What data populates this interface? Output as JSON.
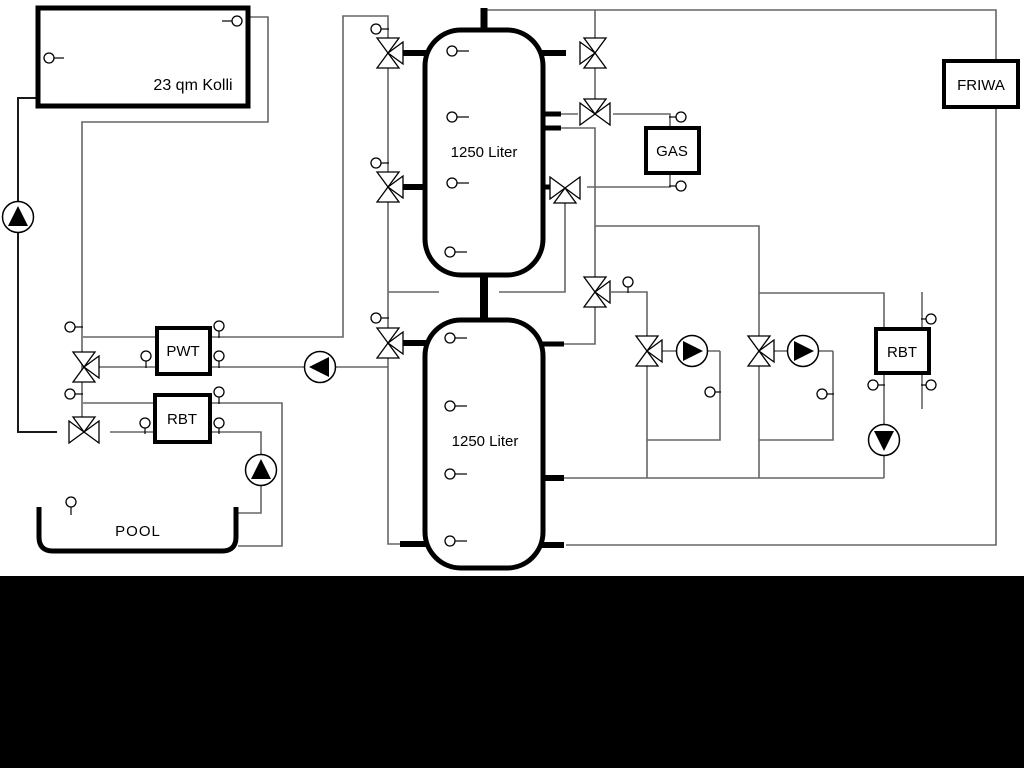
{
  "colors": {
    "background": "#ffffff",
    "band": "#000000",
    "pipe": "#666666",
    "pipe_dark": "#1a1a1a",
    "symbol": "#000000",
    "fill": "#ffffff"
  },
  "labels": {
    "kolli": "23 qm Kolli",
    "tank1": "1250 Liter",
    "tank2": "1250 Liter",
    "pwt": "PWT",
    "rbt_left": "RBT",
    "rbt_right": "RBT",
    "gas": "GAS",
    "friwa": "FRIWA",
    "pool": "POOL"
  },
  "pipes": [
    {
      "name": "pipe-collector-flow",
      "dark": true,
      "pts": [
        [
          38,
          98
        ],
        [
          18,
          98
        ],
        [
          18,
          432
        ],
        [
          57,
          432
        ]
      ]
    },
    {
      "name": "pipe-collector-return",
      "pts": [
        [
          247,
          17
        ],
        [
          268,
          17
        ],
        [
          268,
          122
        ],
        [
          82,
          122
        ],
        [
          82,
          429
        ]
      ]
    },
    {
      "name": "pipe-loading-line",
      "pts": [
        [
          83,
          337
        ],
        [
          343,
          337
        ],
        [
          343,
          16
        ],
        [
          388,
          16
        ],
        [
          388,
          544
        ],
        [
          404,
          544
        ]
      ]
    },
    {
      "name": "pipe-pwt-lower",
      "pts": [
        [
          98,
          367
        ],
        [
          388,
          367
        ]
      ]
    },
    {
      "name": "pipe-rbt-upper-pool",
      "pts": [
        [
          83,
          403
        ],
        [
          282,
          403
        ],
        [
          282,
          546
        ],
        [
          238,
          546
        ]
      ]
    },
    {
      "name": "pipe-rbt-lower-pool",
      "pts": [
        [
          110,
          432
        ],
        [
          261,
          432
        ],
        [
          261,
          513
        ],
        [
          238,
          513
        ]
      ]
    },
    {
      "name": "pipe-top-friwa-loop",
      "pts": [
        [
          484,
          10
        ],
        [
          996,
          10
        ],
        [
          996,
          545
        ],
        [
          566,
          545
        ]
      ]
    },
    {
      "name": "pipe-valve-chain-top",
      "pts": [
        [
          595,
          10
        ],
        [
          595,
          100
        ]
      ]
    },
    {
      "name": "pipe-valve114-left",
      "pts": [
        [
          561,
          114
        ],
        [
          578,
          114
        ]
      ]
    },
    {
      "name": "pipe-valve114-to-gas",
      "pts": [
        [
          613,
          114
        ],
        [
          670,
          114
        ],
        [
          670,
          130
        ]
      ]
    },
    {
      "name": "pipe-tank1-r128-down",
      "pts": [
        [
          561,
          128
        ],
        [
          595,
          128
        ],
        [
          595,
          278
        ]
      ]
    },
    {
      "name": "pipe-gas-return",
      "pts": [
        [
          670,
          171
        ],
        [
          670,
          187
        ],
        [
          587,
          187
        ]
      ]
    },
    {
      "name": "pipe-valve188-down",
      "pts": [
        [
          565,
          202
        ],
        [
          565,
          292
        ],
        [
          499,
          292
        ]
      ]
    },
    {
      "name": "pipe-292-left-segment",
      "pts": [
        [
          388,
          292
        ],
        [
          439,
          292
        ]
      ]
    },
    {
      "name": "pipe-226-branch2",
      "pts": [
        [
          595,
          226
        ],
        [
          759,
          226
        ],
        [
          759,
          338
        ]
      ]
    },
    {
      "name": "pipe-valve292-right",
      "pts": [
        [
          611,
          292
        ],
        [
          647,
          292
        ],
        [
          647,
          338
        ]
      ]
    },
    {
      "name": "pipe-valve292-bottom",
      "pts": [
        [
          595,
          307
        ],
        [
          595,
          344
        ],
        [
          564,
          344
        ]
      ]
    },
    {
      "name": "pipe-branch1-pump",
      "pts": [
        [
          660,
          351
        ],
        [
          720,
          351
        ]
      ]
    },
    {
      "name": "pipe-branch1-loop",
      "pts": [
        [
          720,
          351
        ],
        [
          720,
          440
        ],
        [
          647,
          440
        ]
      ]
    },
    {
      "name": "pipe-branch1-drop",
      "pts": [
        [
          647,
          366
        ],
        [
          647,
          478
        ]
      ]
    },
    {
      "name": "pipe-branch2-pump",
      "pts": [
        [
          771,
          351
        ],
        [
          833,
          351
        ]
      ]
    },
    {
      "name": "pipe-branch2-loop",
      "pts": [
        [
          833,
          351
        ],
        [
          833,
          440
        ],
        [
          759,
          440
        ]
      ]
    },
    {
      "name": "pipe-branch2-drop",
      "pts": [
        [
          759,
          366
        ],
        [
          759,
          478
        ]
      ]
    },
    {
      "name": "pipe-branch2-to-rbt",
      "pts": [
        [
          759,
          293
        ],
        [
          884,
          293
        ],
        [
          884,
          330
        ]
      ]
    },
    {
      "name": "pipe-return-478",
      "pts": [
        [
          564,
          478
        ],
        [
          884,
          478
        ]
      ]
    },
    {
      "name": "pipe-rbt-right-pump",
      "pts": [
        [
          884,
          372
        ],
        [
          884,
          478
        ]
      ]
    },
    {
      "name": "pipe-rbt-right-secondary",
      "pts": [
        [
          922,
          292
        ],
        [
          922,
          409
        ]
      ]
    }
  ],
  "stubs": [
    {
      "name": "stub-tank1-top",
      "w": 7,
      "pts": [
        [
          484,
          8
        ],
        [
          484,
          32
        ]
      ]
    },
    {
      "name": "stub-tank-connector",
      "w": 8,
      "pts": [
        [
          484,
          273
        ],
        [
          484,
          322
        ]
      ]
    },
    {
      "name": "stub-tank1-left-53",
      "w": 6,
      "pts": [
        [
          402,
          53
        ],
        [
          427,
          53
        ]
      ]
    },
    {
      "name": "stub-tank1-left-187",
      "w": 6,
      "pts": [
        [
          402,
          187
        ],
        [
          427,
          187
        ]
      ]
    },
    {
      "name": "stub-tank1-right-53",
      "w": 6,
      "pts": [
        [
          541,
          53
        ],
        [
          566,
          53
        ]
      ]
    },
    {
      "name": "stub-tank1-right-114",
      "w": 5,
      "pts": [
        [
          541,
          114
        ],
        [
          561,
          114
        ]
      ]
    },
    {
      "name": "stub-tank1-right-128",
      "w": 5,
      "pts": [
        [
          541,
          128
        ],
        [
          561,
          128
        ]
      ]
    },
    {
      "name": "stub-tank1-right-187",
      "w": 5,
      "pts": [
        [
          541,
          187
        ],
        [
          554,
          187
        ]
      ]
    },
    {
      "name": "stub-tank2-left-343",
      "w": 6,
      "pts": [
        [
          402,
          343
        ],
        [
          427,
          343
        ]
      ]
    },
    {
      "name": "stub-tank2-left-544",
      "w": 6,
      "pts": [
        [
          400,
          544
        ],
        [
          427,
          544
        ]
      ]
    },
    {
      "name": "stub-tank2-right-344",
      "w": 5,
      "pts": [
        [
          541,
          344
        ],
        [
          564,
          344
        ]
      ]
    },
    {
      "name": "stub-tank2-right-478",
      "w": 6,
      "pts": [
        [
          541,
          478
        ],
        [
          564,
          478
        ]
      ]
    },
    {
      "name": "stub-tank2-right-545",
      "w": 6,
      "pts": [
        [
          541,
          545
        ],
        [
          564,
          545
        ]
      ]
    }
  ],
  "boxes": [
    {
      "name": "collector-box",
      "x": 38,
      "y": 8,
      "w": 210,
      "h": 98,
      "sw": 5,
      "rx": 0,
      "label": "kolli",
      "tx": 193,
      "ty": 90,
      "fs": 16
    },
    {
      "name": "buffer-tank-1",
      "x": 425,
      "y": 30,
      "w": 118,
      "h": 245,
      "sw": 5,
      "rx": 36,
      "label": "tank1",
      "tx": 484,
      "ty": 157,
      "fs": 15
    },
    {
      "name": "buffer-tank-2",
      "x": 425,
      "y": 320,
      "w": 118,
      "h": 248,
      "sw": 5,
      "rx": 36,
      "label": "tank2",
      "tx": 485,
      "ty": 446,
      "fs": 15
    },
    {
      "name": "pwt-heat-exchanger",
      "x": 157,
      "y": 328,
      "w": 53,
      "h": 46,
      "sw": 4,
      "rx": 0,
      "label": "pwt",
      "tx": 183,
      "ty": 356,
      "fs": 15
    },
    {
      "name": "rbt-left-heat-exchanger",
      "x": 155,
      "y": 395,
      "w": 55,
      "h": 47,
      "sw": 4,
      "rx": 0,
      "label": "rbt_left",
      "tx": 182,
      "ty": 424,
      "fs": 15
    },
    {
      "name": "gas-boiler",
      "x": 646,
      "y": 128,
      "w": 53,
      "h": 45,
      "sw": 4,
      "rx": 0,
      "label": "gas",
      "tx": 672,
      "ty": 156,
      "fs": 15
    },
    {
      "name": "friwa-station",
      "x": 944,
      "y": 61,
      "w": 74,
      "h": 46,
      "sw": 4,
      "rx": 0,
      "label": "friwa",
      "tx": 981,
      "ty": 90,
      "fs": 15
    },
    {
      "name": "rbt-right-heat-exchanger",
      "x": 876,
      "y": 329,
      "w": 53,
      "h": 44,
      "sw": 4,
      "rx": 0,
      "label": "rbt_right",
      "tx": 902,
      "ty": 357,
      "fs": 15
    }
  ],
  "pool": {
    "name": "pool-basin",
    "path": "M 39 507 L 39 537 Q 39 551 53 551 L 222 551 Q 236 551 236 537 L 236 507",
    "sw": 5,
    "label": "pool",
    "tx": 138,
    "ty": 536,
    "fs": 15
  },
  "valves": [
    {
      "name": "valve-loading-tank1-top",
      "x": 388,
      "y": 53,
      "axis": "v",
      "branch": "r"
    },
    {
      "name": "valve-loading-tank1-mid",
      "x": 388,
      "y": 187,
      "axis": "v",
      "branch": "r"
    },
    {
      "name": "valve-loading-tank2",
      "x": 388,
      "y": 343,
      "axis": "v",
      "branch": "r"
    },
    {
      "name": "valve-tank1-top-right",
      "x": 595,
      "y": 53,
      "axis": "v",
      "branch": "l"
    },
    {
      "name": "valve-gas-flow",
      "x": 595,
      "y": 114,
      "axis": "h",
      "branch": "t"
    },
    {
      "name": "valve-gas-return",
      "x": 565,
      "y": 188,
      "axis": "h",
      "branch": "b"
    },
    {
      "name": "valve-distributor",
      "x": 595,
      "y": 292,
      "axis": "v",
      "branch": "r"
    },
    {
      "name": "valve-branch1",
      "x": 647,
      "y": 351,
      "axis": "v",
      "branch": "r"
    },
    {
      "name": "valve-branch2",
      "x": 759,
      "y": 351,
      "axis": "v",
      "branch": "r"
    },
    {
      "name": "valve-pwt-primary",
      "x": 84,
      "y": 367,
      "axis": "v",
      "branch": "r"
    },
    {
      "name": "valve-pool-circuit",
      "x": 84,
      "y": 432,
      "axis": "h",
      "branch": "t"
    }
  ],
  "pumps": [
    {
      "name": "pump-solar",
      "x": 18,
      "y": 217,
      "dir": "up"
    },
    {
      "name": "pump-pwt",
      "x": 320,
      "y": 367,
      "dir": "left"
    },
    {
      "name": "pump-pool",
      "x": 261,
      "y": 470,
      "dir": "up"
    },
    {
      "name": "pump-branch1",
      "x": 692,
      "y": 351,
      "dir": "right"
    },
    {
      "name": "pump-branch2",
      "x": 803,
      "y": 351,
      "dir": "right"
    },
    {
      "name": "pump-rbt-right",
      "x": 884,
      "y": 440,
      "dir": "down"
    }
  ],
  "sensors": [
    {
      "x": 49,
      "y": 58,
      "dir": "r",
      "len": 10
    },
    {
      "x": 237,
      "y": 21,
      "dir": "l",
      "len": 10
    },
    {
      "x": 70,
      "y": 327,
      "dir": "r",
      "len": 8
    },
    {
      "x": 70,
      "y": 394,
      "dir": "r",
      "len": 8
    },
    {
      "x": 146,
      "y": 356,
      "dir": "d",
      "len": 7
    },
    {
      "x": 219,
      "y": 356,
      "dir": "d",
      "len": 7
    },
    {
      "x": 219,
      "y": 326,
      "dir": "d",
      "len": 7
    },
    {
      "x": 219,
      "y": 392,
      "dir": "d",
      "len": 7
    },
    {
      "x": 145,
      "y": 423,
      "dir": "d",
      "len": 6
    },
    {
      "x": 219,
      "y": 423,
      "dir": "d",
      "len": 6
    },
    {
      "x": 71,
      "y": 502,
      "dir": "d",
      "len": 8
    },
    {
      "x": 376,
      "y": 29,
      "dir": "r",
      "len": 8
    },
    {
      "x": 376,
      "y": 163,
      "dir": "r",
      "len": 8
    },
    {
      "x": 376,
      "y": 318,
      "dir": "r",
      "len": 8
    },
    {
      "x": 452,
      "y": 51,
      "dir": "r",
      "len": 12
    },
    {
      "x": 452,
      "y": 117,
      "dir": "r",
      "len": 12
    },
    {
      "x": 452,
      "y": 183,
      "dir": "r",
      "len": 12
    },
    {
      "x": 450,
      "y": 252,
      "dir": "r",
      "len": 12
    },
    {
      "x": 450,
      "y": 338,
      "dir": "r",
      "len": 12
    },
    {
      "x": 450,
      "y": 406,
      "dir": "r",
      "len": 12
    },
    {
      "x": 450,
      "y": 474,
      "dir": "r",
      "len": 12
    },
    {
      "x": 450,
      "y": 541,
      "dir": "r",
      "len": 12
    },
    {
      "x": 681,
      "y": 117,
      "dir": "l",
      "len": 7
    },
    {
      "x": 681,
      "y": 186,
      "dir": "l",
      "len": 7
    },
    {
      "x": 628,
      "y": 282,
      "dir": "d",
      "len": 6
    },
    {
      "x": 710,
      "y": 392,
      "dir": "r",
      "len": 6
    },
    {
      "x": 822,
      "y": 394,
      "dir": "r",
      "len": 7
    },
    {
      "x": 873,
      "y": 385,
      "dir": "r",
      "len": 7
    },
    {
      "x": 931,
      "y": 319,
      "dir": "l",
      "len": 5
    },
    {
      "x": 931,
      "y": 385,
      "dir": "l",
      "len": 5
    }
  ],
  "band": {
    "y": 576,
    "h": 192
  }
}
